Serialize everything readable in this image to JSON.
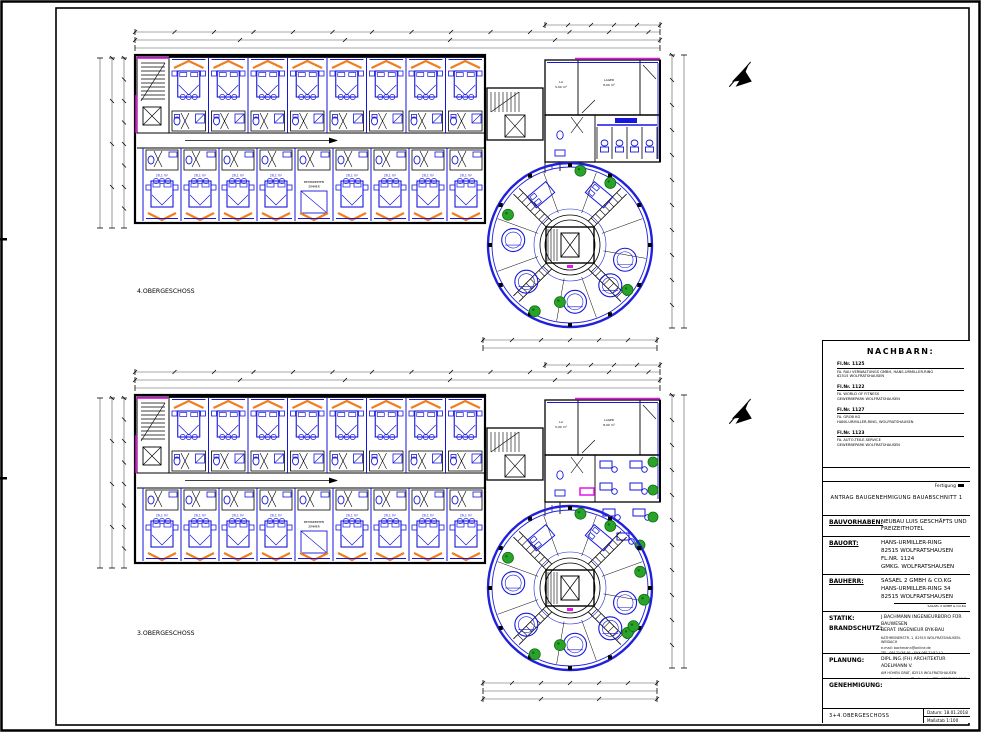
{
  "document": {
    "type": "Architekturplan / Bauantragszeichnung",
    "sheet_name": "3+4.OBERGESCHOSS",
    "datum": "Datum:  18.01.2018",
    "massstab": "Maßstab 1:100"
  },
  "floors": [
    {
      "id": "og4",
      "label": "4.OBERGESCHOSS",
      "variant": "upper"
    },
    {
      "id": "og3",
      "label": "3.OBERGESCHOSS",
      "variant": "lower"
    }
  ],
  "plan": {
    "rooms_top_row": 8,
    "rooms_bottom_row": 9,
    "room_label": "26,1 m²",
    "special_room": {
      "index": 4,
      "lines": [
        "BEHINDERTEN",
        "ZIMMER"
      ]
    },
    "connector": {
      "la_room": [
        "LA",
        "5,00 m²"
      ],
      "lager_room": [
        "LAGER",
        "8,00 m²"
      ]
    }
  },
  "title_block": {
    "nachbarn_title": "NACHBARN:",
    "neighbors": [
      {
        "flnr": "Fl.Nr. 1125",
        "lines": [
          "FA. RAU VERWALTUNGS GMBH, HANS-URMILLER-RING",
          "82515 WOLFRATSHAUSEN"
        ]
      },
      {
        "flnr": "Fl.Nr. 1122",
        "lines": [
          "FA. WORLD OF FITNESS",
          "GEWERBEPARK WOLFRATSHAUSEN"
        ]
      },
      {
        "flnr": "Fl.Nr. 1127",
        "lines": [
          "FA. GROB KG",
          "HANS-URMILLER-RING, WOLFRATSHAUSEN"
        ]
      },
      {
        "flnr": "Fl.Nr. 1123",
        "lines": [
          "FA. AUTO-TEILE-SERVICE",
          "GEWERBEPARK WOLFRATSHAUSEN"
        ]
      }
    ],
    "fertigung": "Fertigung",
    "antrag": "ANTRAG BAUGENEHMIGUNG BAUABSCHNITT 1",
    "bauvorhaben_label": "BAUVORHABEN:",
    "bauvorhaben_lines": [
      "NEUBAU LUIS GESCHÄFTS UND",
      "FREIZEITHOTEL"
    ],
    "bauort_label": "BAUORT:",
    "bauort_lines": [
      "HANS-URMILLER-RING",
      "82515 WOLFRATSHAUSEN",
      "FL.NR. 1124",
      "GMKG. WOLFRATSHAUSEN"
    ],
    "bauherr_label": "BAUHERR:",
    "bauherr_lines": [
      "SASAEL 2 GMBH & CO.KG",
      "HANS-URMILLER-RING 34",
      "82515 WOLFRATSHAUSEN"
    ],
    "bauherr_stamp": "SASAEL 2 GMBH & CO.KG",
    "statik_label": "STATIK:",
    "brandschutz_label": "BRANDSCHUTZ:",
    "statik_lines": [
      "J.BACHMANN INGENIEURBÜRO FÜR BAUWESEN",
      "BERAT. INGENIEUR BYK-BAU"
    ],
    "statik_small": [
      "KATHREINERSTR. 1, 82515 WOLFRATSHAUSEN-WEIDACH",
      "e-mail: bachmann@online.de",
      "TEL. 08171/38 91 · FAX 08171/42 11"
    ],
    "planung_label": "PLANUNG:",
    "planung_line": "DIPL.ING.(FH) ARCHITEKTUR ADELMANN V.",
    "planung_small": [
      "AM HOHEN GRAT, 82515 WOLFRATSHAUSEN",
      "e-mail: adelmann@online.de · TEL. 08171/21 96 7"
    ],
    "genehmigung_label": "GENEHMIGUNG:",
    "sheet_name": "3+4.OBERGESCHOSS",
    "datum": "Datum:  18.01.2018",
    "massstab": "Maßstab 1:100"
  },
  "colors": {
    "wall_black": "#000000",
    "furniture_blue": "#1616dd",
    "tower_blue": "#2121dd",
    "accent_orange": "#f07d1e",
    "accent_magenta": "#e812e8",
    "tree_green": "#2aa32a",
    "tree_green_dark": "#0e6e0e",
    "dim_gray": "#555555",
    "paper": "#ffffff"
  }
}
